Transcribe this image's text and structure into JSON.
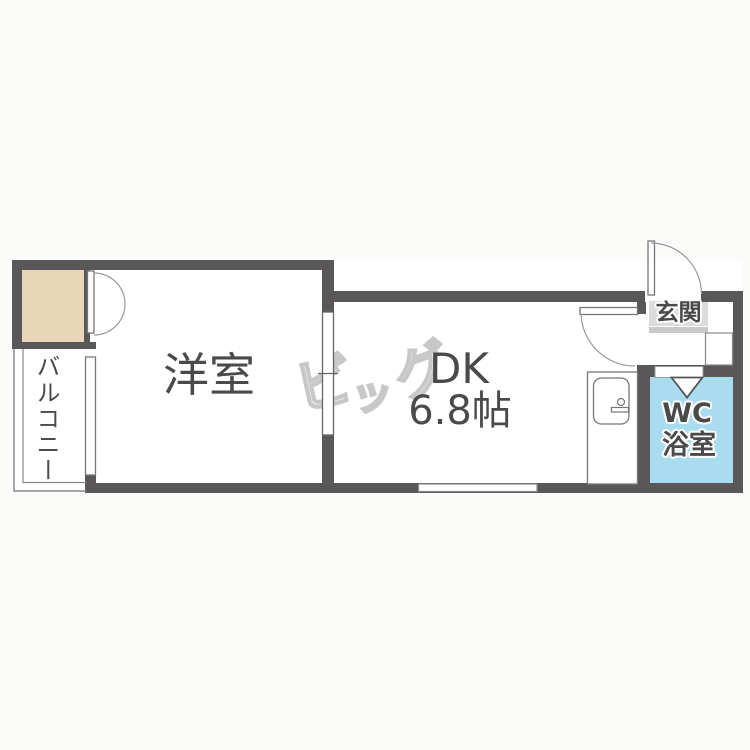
{
  "colors": {
    "wall": "#595757",
    "closet": "#e9d6b8",
    "bathroom": "#a9dcef",
    "label_box": "#dcdcdc",
    "step": "#c9c9c9",
    "text": "#4a4a4a",
    "outline": "#777777",
    "watermark": "#c8c8c8",
    "background": "#fbfbf9"
  },
  "rooms": {
    "western": {
      "label": "洋室"
    },
    "dk": {
      "label": "DK",
      "size": "6.8帖"
    },
    "entrance": {
      "label": "玄関"
    },
    "bath": {
      "wc": "WC",
      "bath": "浴室"
    },
    "balcony": {
      "label": "バルコニー"
    }
  },
  "watermark": {
    "char_bi": "ビ",
    "char_tsu": "ッ",
    "char_gu": "グ"
  }
}
